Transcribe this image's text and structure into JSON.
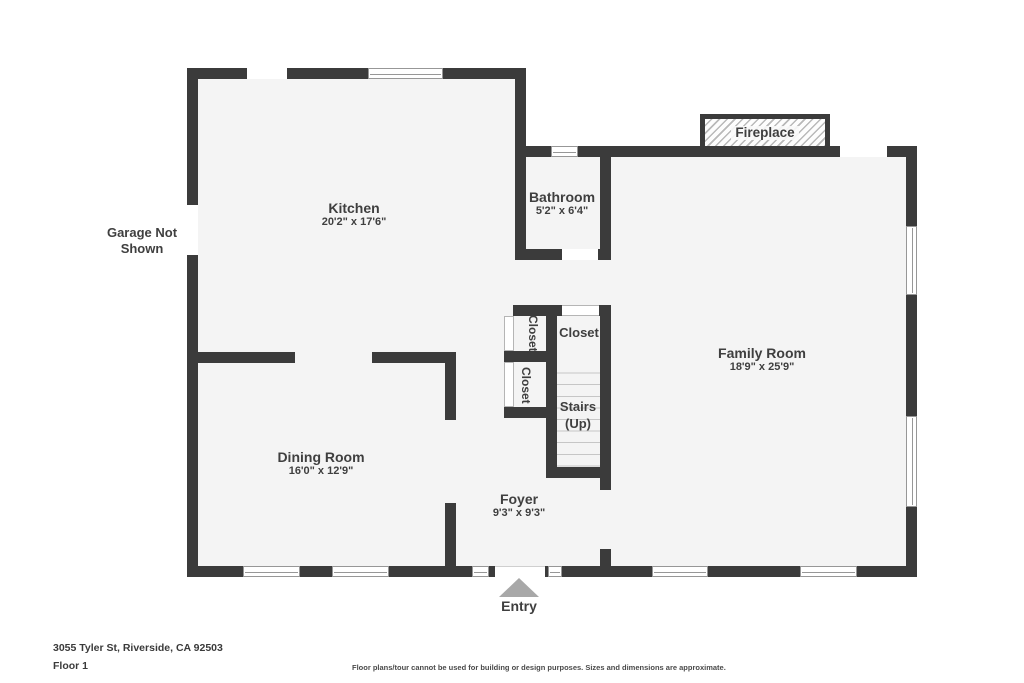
{
  "rooms": {
    "kitchen": {
      "name": "Kitchen",
      "dims": "20'2\" x 17'6\""
    },
    "bathroom": {
      "name": "Bathroom",
      "dims": "5'2\" x 6'4\""
    },
    "family_room": {
      "name": "Family Room",
      "dims": "18'9\" x 25'9\""
    },
    "dining_room": {
      "name": "Dining Room",
      "dims": "16'0\" x 12'9\""
    },
    "foyer": {
      "name": "Foyer",
      "dims": "9'3\" x 9'3\""
    }
  },
  "features": {
    "closet_upper_left": "Closet",
    "closet_main": "Closet",
    "closet_lower_left": "Closet",
    "stairs_line1": "Stairs",
    "stairs_line2": "(Up)",
    "fireplace": "Fireplace",
    "garage_note": "Garage Not Shown",
    "entry": "Entry"
  },
  "footer": {
    "address": "3055 Tyler St, Riverside, CA 92503",
    "floor": "Floor 1",
    "disclaimer": "Floor plans/tour cannot be used for building or design purposes. Sizes and dimensions are approximate."
  },
  "colors": {
    "wall": "#3b3b3b",
    "floor": "#f4f4f4",
    "text": "#3f3f3f",
    "entry_arrow": "#a8a8a8"
  }
}
